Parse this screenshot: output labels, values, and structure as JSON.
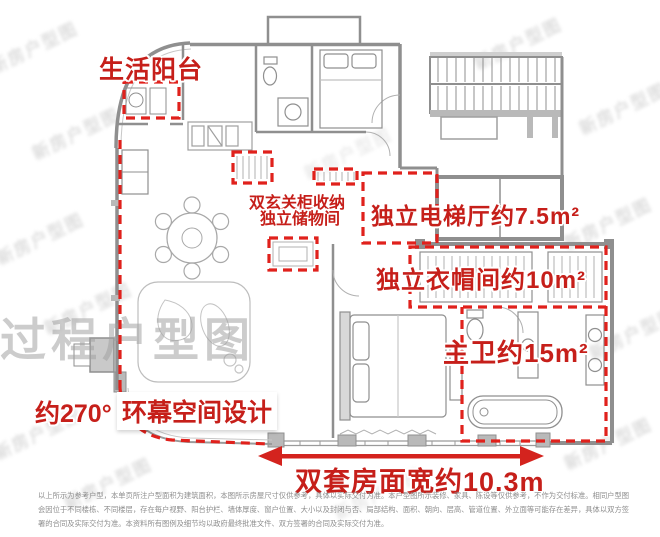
{
  "annotations": {
    "life_balcony": {
      "label": "生活阳台"
    },
    "foyer": {
      "line1": "双玄关柜收纳",
      "line2": "独立储物间"
    },
    "elevator_hall": {
      "label": "独立电梯厅约7.5m²"
    },
    "cloakroom": {
      "label": "独立衣帽间约10m²"
    },
    "master_bath": {
      "label": "主卫约15m²"
    },
    "panorama": {
      "prefix": "约270°",
      "label": "环幕空间设计"
    },
    "width_dimension": {
      "label": "双套房面宽约10.3m"
    }
  },
  "watermarks": {
    "process_plan": "过程户型图",
    "diagonal": "新房户型图"
  },
  "disclaimer": {
    "line1": "以上所示为参考户型，本单页所注户型面积为建筑面积，本图所示房屋尺寸仅供参考，具体以实际交付为准。本户型图所示装修、家具、陈设等仅供参考，不作为交付标准。相同户型图",
    "line2": "会因位于不同楼栋、不同楼层，存在每户视野、阳台护栏、墙体厚度、窗户位置、大小以及封闭与否、局部结构、面积、朝向、层高、管道位置、外立面等可能存在差异，具体以双方签",
    "line3": "署的合同及实际交付为准。本资料所有图例及细节均以政府最终批准文件、双方签署的合同及实际交付为准。"
  },
  "colors": {
    "annotation_red": "#d0201b",
    "wall_gray": "#8f8f8f",
    "watermark_gray": "#9f9f9f",
    "disclaimer_gray": "#8d8d8d"
  }
}
